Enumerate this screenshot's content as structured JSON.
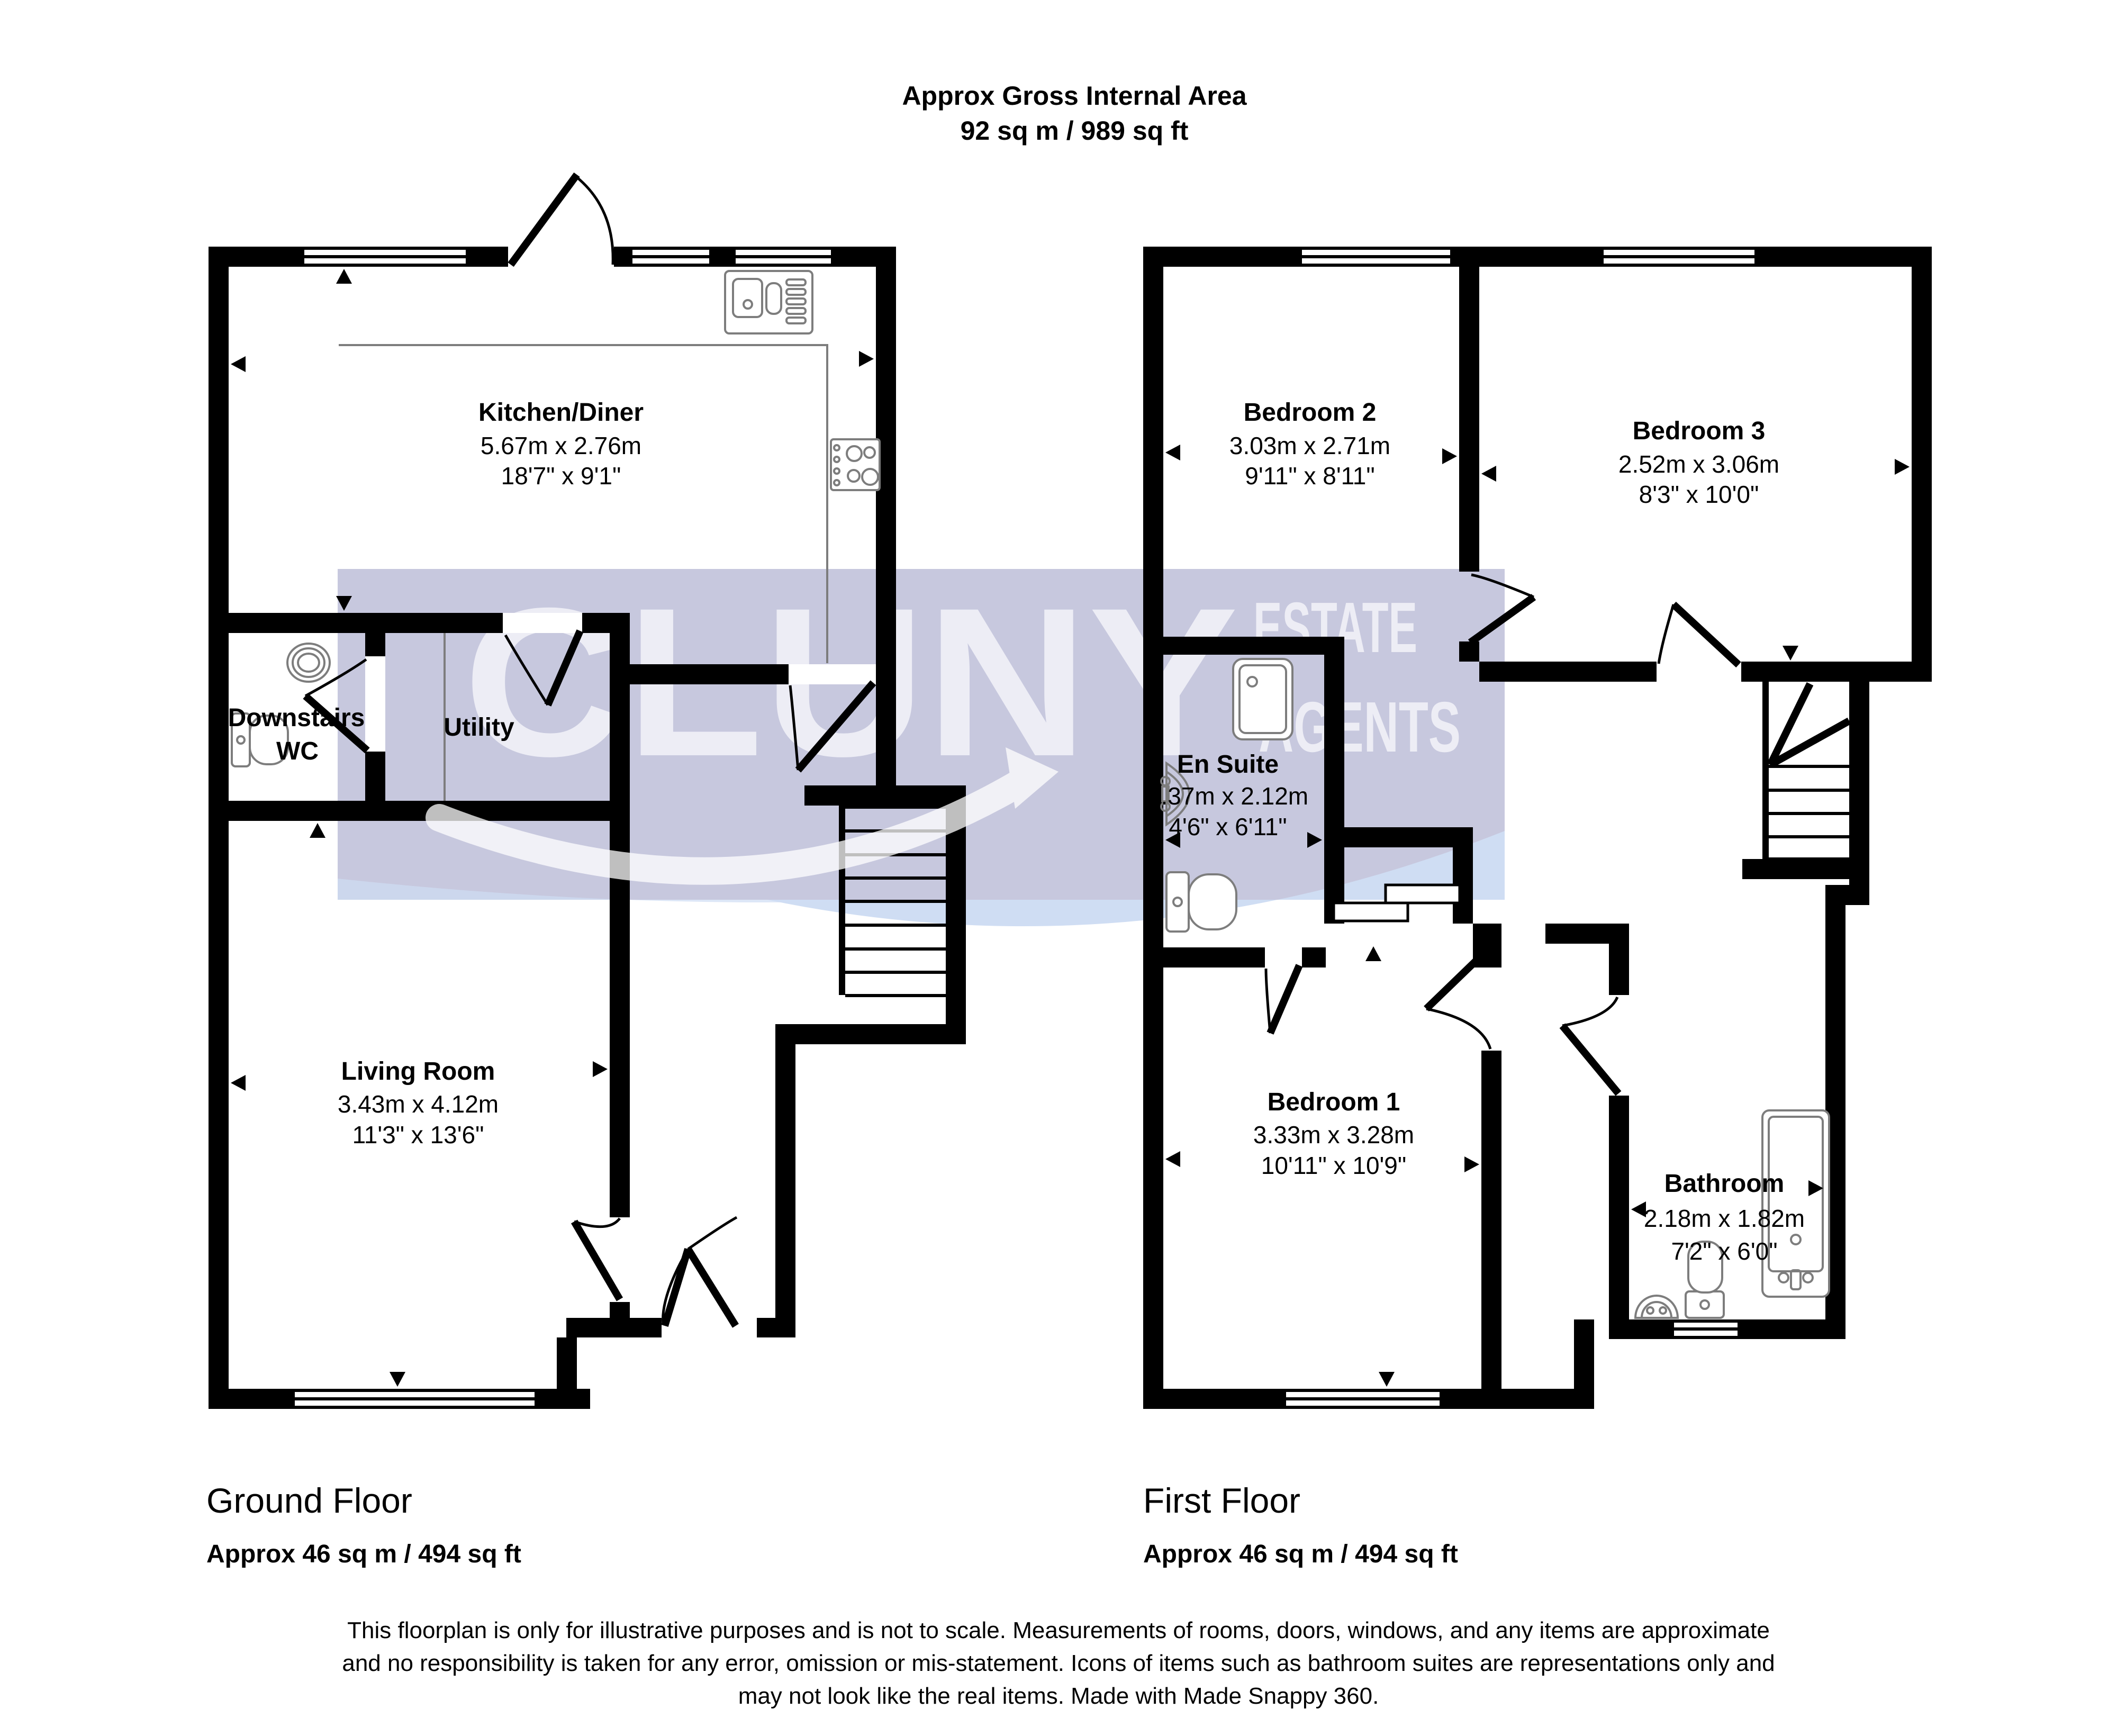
{
  "header": {
    "line1": "Approx Gross Internal Area",
    "line2": "92 sq m / 989 sq ft"
  },
  "watermark": {
    "brand": "CLUNY",
    "sub1": "ESTATE",
    "sub2": "AGENTS",
    "band_color": "#c7c8de",
    "swoosh_color": "#cfddf3",
    "letter_color": "#f0f0f7"
  },
  "ground_floor": {
    "title": "Ground Floor",
    "area": "Approx 46 sq m / 494 sq ft",
    "rooms": {
      "kitchen_diner": {
        "name": "Kitchen/Diner",
        "metric": "5.67m x 2.76m",
        "imperial": "18'7\" x 9'1\""
      },
      "downstairs_wc": {
        "name_line1": "Downstairs",
        "name_line2": "WC"
      },
      "utility": {
        "name": "Utility"
      },
      "living_room": {
        "name": "Living Room",
        "metric": "3.43m x 4.12m",
        "imperial": "11'3\" x 13'6\""
      }
    }
  },
  "first_floor": {
    "title": "First Floor",
    "area": "Approx 46 sq m / 494 sq ft",
    "rooms": {
      "bedroom_2": {
        "name": "Bedroom 2",
        "metric": "3.03m x 2.71m",
        "imperial": "9'11\" x 8'11\""
      },
      "bedroom_3": {
        "name": "Bedroom 3",
        "metric": "2.52m x 3.06m",
        "imperial": "8'3\" x 10'0\""
      },
      "en_suite": {
        "name": "En Suite",
        "metric": "1.37m x 2.12m",
        "imperial": "4'6\" x 6'11\""
      },
      "bedroom_1": {
        "name": "Bedroom 1",
        "metric": "3.33m x 3.28m",
        "imperial": "10'11\" x 10'9\""
      },
      "bathroom": {
        "name": "Bathroom",
        "metric": "2.18m x 1.82m",
        "imperial": "7'2\" x 6'0\""
      }
    }
  },
  "footer": {
    "line1": "This floorplan is only for illustrative purposes and is not to scale. Measurements of rooms, doors, windows, and any items are approximate",
    "line2": "and no responsibility is taken for any error, omission or mis-statement. Icons of items such as bathroom suites are representations only and",
    "line3": "may not look like the real items. Made with Made Snappy 360."
  },
  "colors": {
    "wall": "#000000",
    "fixture_outline": "#7d7d7d",
    "text": "#000000"
  }
}
